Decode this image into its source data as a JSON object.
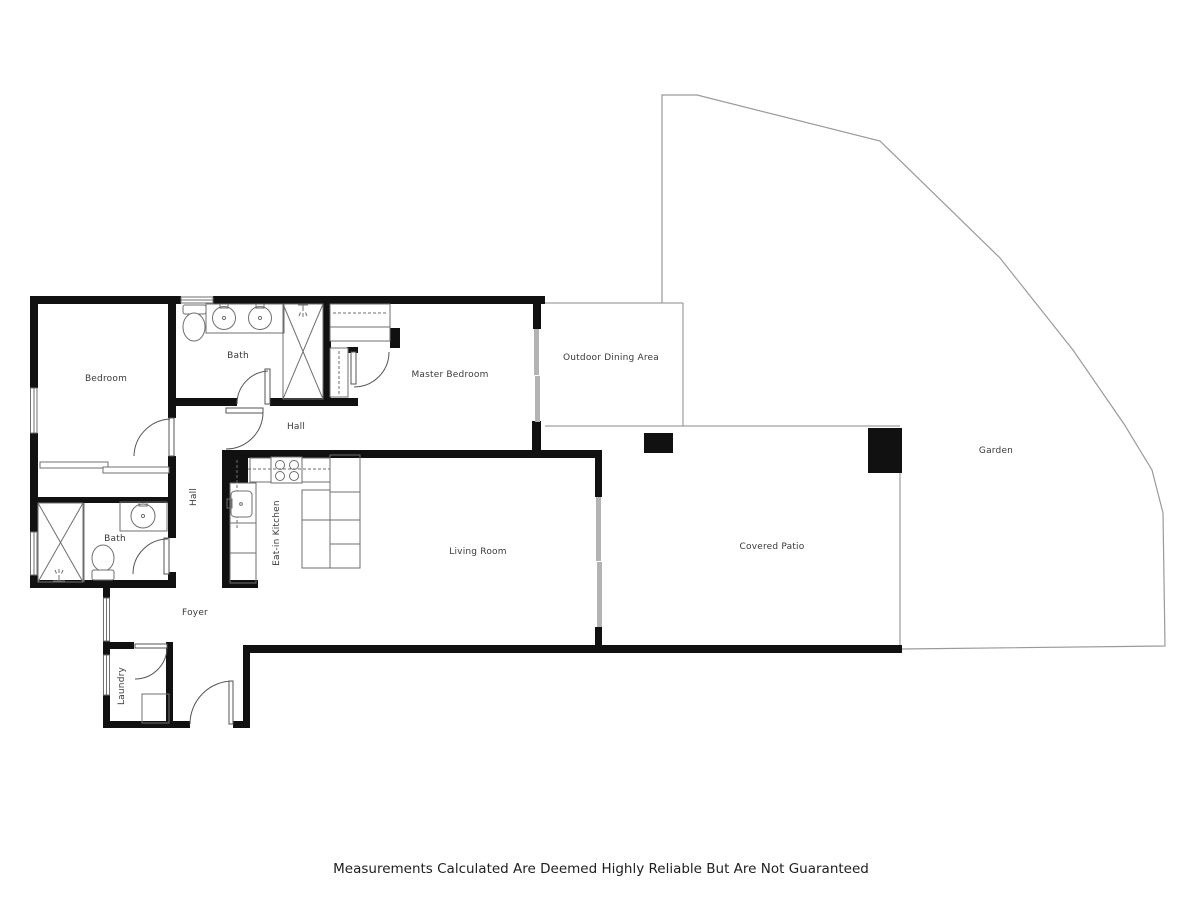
{
  "title": "Floor Plan",
  "rooms": {
    "bedroom": {
      "label": "Bedroom"
    },
    "bath_top": {
      "label": "Bath"
    },
    "hall_top": {
      "label": "Hall"
    },
    "hall_side": {
      "label": "Hall"
    },
    "master_bedroom": {
      "label": "Master Bedroom"
    },
    "outdoor_dining": {
      "label": "Outdoor Dining Area"
    },
    "garden": {
      "label": "Garden"
    },
    "eat_in_kitchen": {
      "label": "Eat-in Kitchen"
    },
    "living_room": {
      "label": "Living Room"
    },
    "covered_patio": {
      "label": "Covered Patio"
    },
    "bath_lower": {
      "label": "Bath"
    },
    "foyer": {
      "label": "Foyer"
    },
    "laundry": {
      "label": "Laundry"
    }
  },
  "disclaimer": "Measurements Calculated Are Deemed Highly Reliable But Are Not Guaranteed",
  "colors": {
    "wall": "#111111",
    "site": "#9a9a9a",
    "slider": "#b3b3b3",
    "text": "#3a3a3a",
    "fixture": "#6f6f6f",
    "door": "#555555"
  }
}
